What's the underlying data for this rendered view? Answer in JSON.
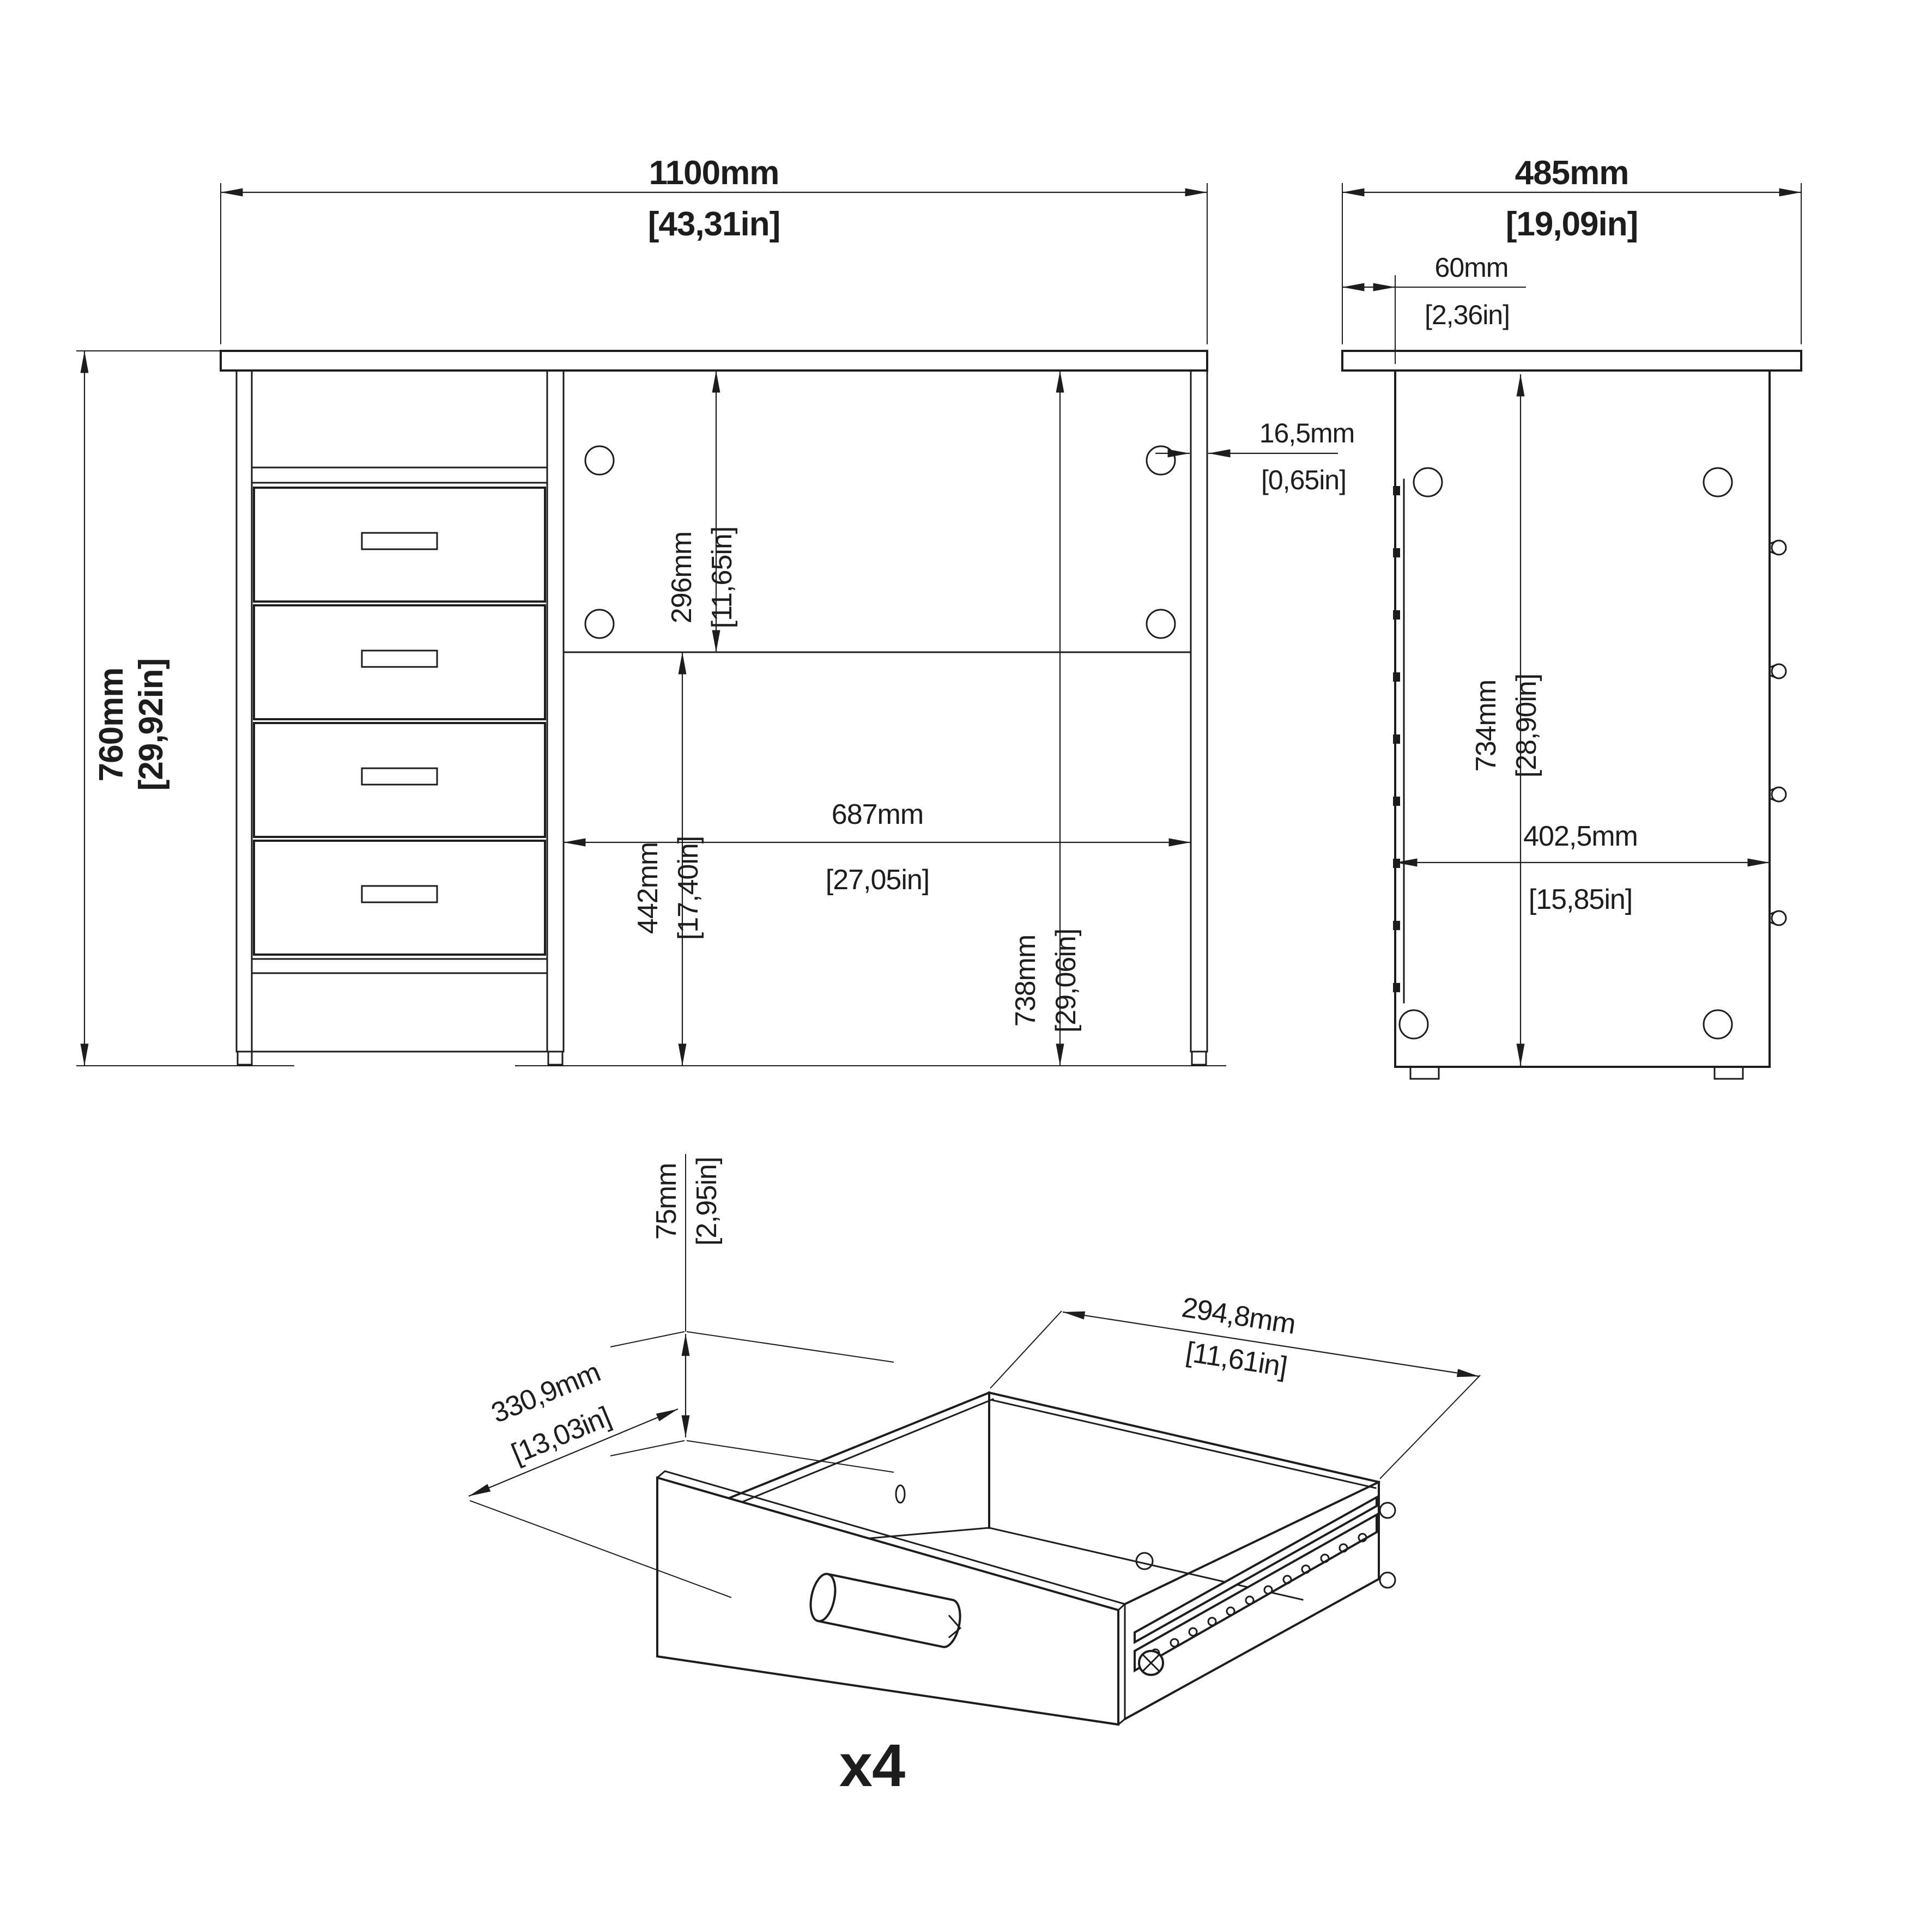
{
  "drawing": {
    "ink_color": "#1d1d1b",
    "background_color": "#ffffff",
    "views": {
      "front": {
        "dims": {
          "overall_width": {
            "mm": "1100mm",
            "in": "[43,31in]"
          },
          "overall_height": {
            "mm": "760mm",
            "in": "[29,92in]"
          },
          "back_panel_height": {
            "mm": "296mm",
            "in": "[11,65in]"
          },
          "kneehole_width": {
            "mm": "687mm",
            "in": "[27,05in]"
          },
          "lower_clear_height": {
            "mm": "442mm",
            "in": "[17,40in]"
          },
          "under_top_height": {
            "mm": "738mm",
            "in": "[29,06in]"
          },
          "panel_thickness": {
            "mm": "16,5mm",
            "in": "[0,65in]"
          }
        }
      },
      "side": {
        "dims": {
          "overall_depth": {
            "mm": "485mm",
            "in": "[19,09in]"
          },
          "top_overhang": {
            "mm": "60mm",
            "in": "[2,36in]"
          },
          "panel_height": {
            "mm": "734mm",
            "in": "[28,90in]"
          },
          "panel_depth": {
            "mm": "402,5mm",
            "in": "[15,85in]"
          }
        }
      },
      "drawer_detail": {
        "quantity_label": "x4",
        "dims": {
          "inner_height": {
            "mm": "75mm",
            "in": "[2,95in]"
          },
          "inner_depth": {
            "mm": "330,9mm",
            "in": "[13,03in]"
          },
          "inner_width": {
            "mm": "294,8mm",
            "in": "[11,61in]"
          }
        }
      }
    }
  }
}
